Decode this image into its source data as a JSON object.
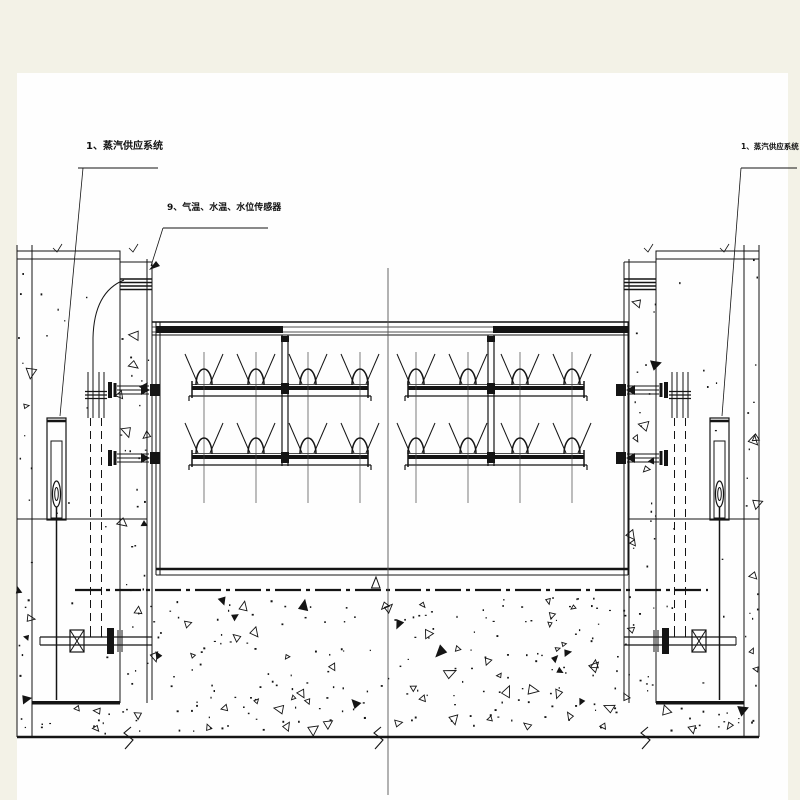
{
  "page": {
    "margin_color": "#f3f2e7",
    "sheet_color": "#fefefe"
  },
  "colors": {
    "line": "#141414",
    "centerline": "#555555",
    "text": "#111111"
  },
  "labels": {
    "left_steam": "1、蒸汽供应系统",
    "sensors": "9、气温、水温、水位传感器",
    "right_steam": "1、蒸汽供应系统"
  }
}
